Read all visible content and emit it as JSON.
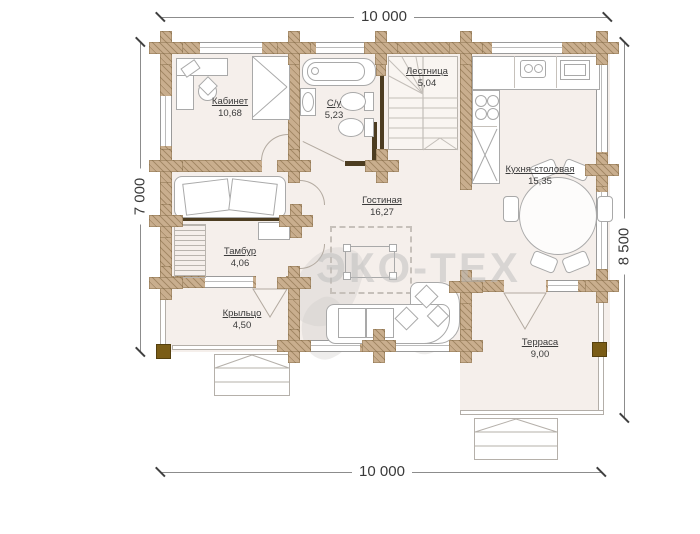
{
  "dimensions": {
    "top": "10 000",
    "bottom": "10 000",
    "left": "7 000",
    "right": "8 500"
  },
  "rooms": {
    "kabinet": {
      "name": "Кабинет",
      "area": "10,68"
    },
    "su": {
      "name": "С/у",
      "area": "5,23"
    },
    "lestnitsa": {
      "name": "Лестница",
      "area": "5,04"
    },
    "kuhnya": {
      "name": "Кухня-столовая",
      "area": "15,35"
    },
    "gostinaya": {
      "name": "Гостиная",
      "area": "16,27"
    },
    "tambur": {
      "name": "Тамбур",
      "area": "4,06"
    },
    "kryltso": {
      "name": "Крыльцо",
      "area": "4,50"
    },
    "terrasa": {
      "name": "Терраса",
      "area": "9,00"
    }
  },
  "watermark": {
    "text": "ЭКО-ТЕХ"
  },
  "colors": {
    "wall": "#c9ae8e",
    "dark_wall": "#4d3d21",
    "floor": "#f5efeb",
    "outline": "#a9a9a9",
    "text": "#3b3b3b",
    "watermark": "#bdbdbd"
  }
}
